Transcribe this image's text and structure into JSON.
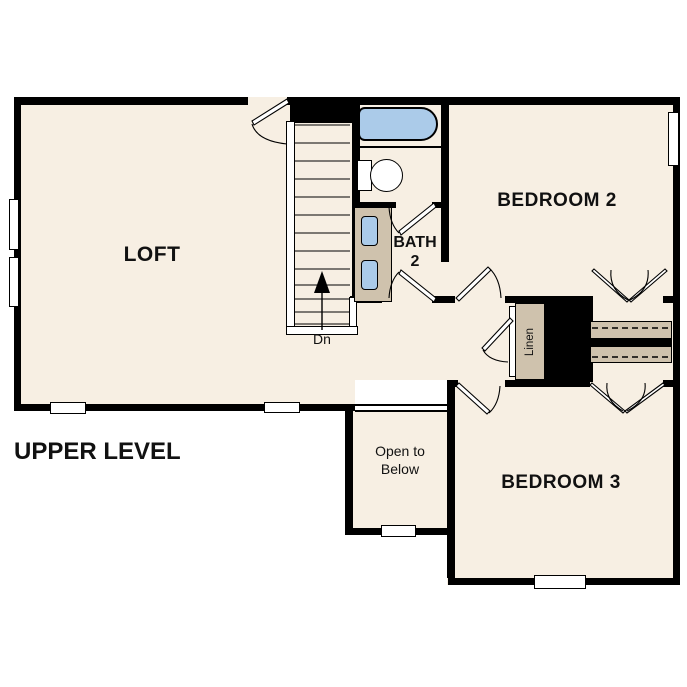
{
  "plan": {
    "title": "UPPER LEVEL",
    "rooms": {
      "loft": {
        "label": "LOFT"
      },
      "bedroom2": {
        "label": "BEDROOM 2"
      },
      "bedroom3": {
        "label": "BEDROOM 3"
      },
      "bath2": {
        "label_line1": "BATH",
        "label_line2": "2"
      },
      "open_to_below": {
        "label": "Open to Below"
      },
      "linen": {
        "label": "Linen"
      }
    },
    "stairs": {
      "down_label": "Dn"
    },
    "fixtures": [
      "bathtub",
      "toilet",
      "vanity-double-sink",
      "linen-closet",
      "closet-rod-shelves",
      "stair-railing",
      "windows"
    ],
    "colors": {
      "floor": "#f7efe3",
      "wall": "#000000",
      "fixture_tan": "#cfc2ad",
      "fixture_blue": "#abcbe9",
      "background": "#ffffff",
      "text": "#111111"
    }
  }
}
